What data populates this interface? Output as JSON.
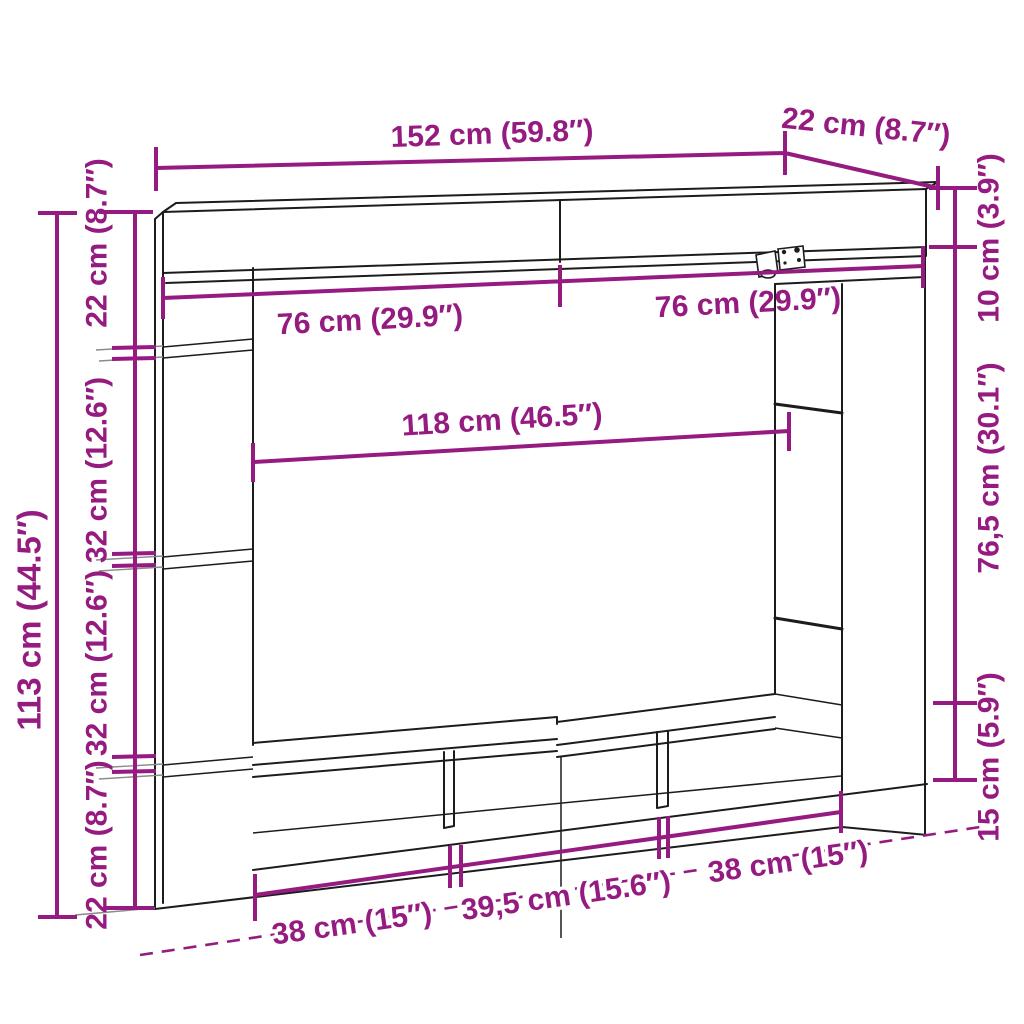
{
  "diagram": {
    "type": "furniture-dimension-drawing",
    "subject": "TV wall unit line drawing with dimension annotations",
    "colors": {
      "dimension_accent": "#951b81",
      "drawing_outline": "#1c1c1c",
      "extension_lines": "#8a8a8a",
      "background": "#ffffff"
    },
    "labels": {
      "top_width": "152 cm (59.8″)",
      "top_depth": "22 cm (8.7″)",
      "left_total_height": "113 cm (44.5″)",
      "left_seg_top": "22 cm (8.7″)",
      "left_seg_upper_mid": "32 cm (12.6″)",
      "left_seg_lower_mid": "32 cm (12.6″)",
      "left_seg_bottom": "22 cm (8.7″)",
      "inner_left_half_width": "76 cm (29.9″)",
      "inner_right_half_width": "76 cm (29.9″)",
      "inner_opening_width": "118 cm (46.5″)",
      "right_top_height": "10 cm (3.9″)",
      "right_middle_height": "76,5 cm (30.1″)",
      "right_bottom_height": "15 cm (5.9″)",
      "bottom_left_width": "38 cm (15″)",
      "bottom_middle_width": "39,5 cm (15.6″)",
      "bottom_right_width": "38 cm (15″)"
    }
  }
}
